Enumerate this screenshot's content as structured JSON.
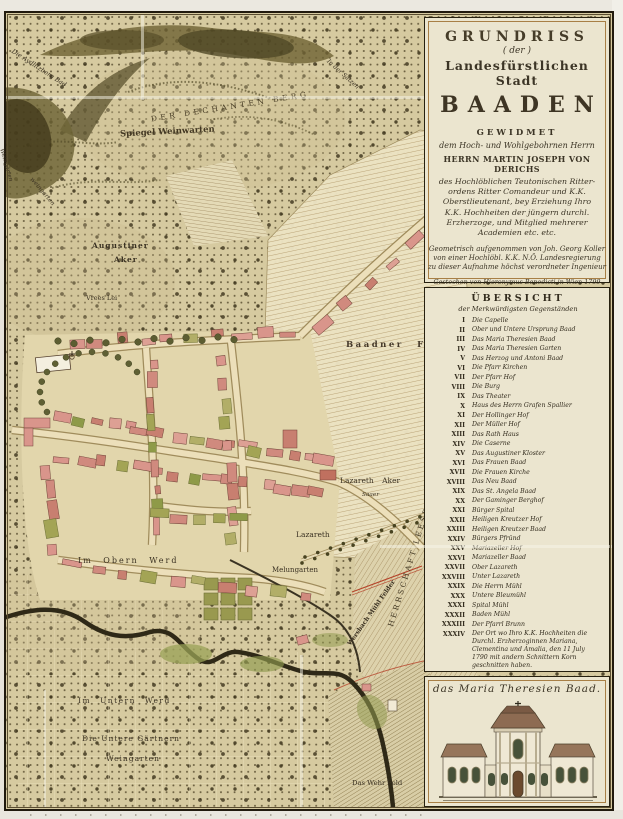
{
  "document_type": "Engraved town plan (hand-coloured), Baden bei Wien, 1799",
  "title_cartouche": {
    "line1": "GRUNDRISS",
    "line2": "( der )",
    "line3": "Landesfürstlichen Stadt",
    "line4": "BAADEN",
    "dedication_header": "GEWIDMET",
    "dedication_sub": "dem Hoch- und Wohlgebohrnen Herrn",
    "dedicatee": "HERRN MARTIN JOSEPH VON DERICHS",
    "dedication_lines": [
      "des Hochlöblichen Teutonischen Ritter-",
      "ordens Ritter Comandeur und K.K.",
      "Oberstlieutenant, bey Erziehung Ihro",
      "K.K. Hochheiten der jüngern durchl.",
      "Erzherzoge, und Mitglied mehrerer",
      "Academien etc. etc."
    ],
    "surveyor_lines": [
      "Geometrisch aufgenommen von Joh. Georg Koller",
      "von einer Hochlöbl. K.K. N.Ö. Landesregierung",
      "zu dieser Aufnahme höchst verordneter Ingenieur"
    ],
    "engraver_line": "Gestochen von Hieronymus Benedicti in Wien 1799"
  },
  "legend": {
    "title": "ÜBERSICHT",
    "subtitle": "der Merkwürdigsten Gegenständen",
    "entries": [
      {
        "numeral": "I",
        "label": "Die Capelle"
      },
      {
        "numeral": "II",
        "label": "Ober und Untere Ursprung Baad"
      },
      {
        "numeral": "III",
        "label": "Das Maria Theresien Baad"
      },
      {
        "numeral": "IV",
        "label": "Das Maria Theresien Garten"
      },
      {
        "numeral": "V",
        "label": "Das Herzog und Antoni Baad"
      },
      {
        "numeral": "VI",
        "label": "Die Pfarr Kirchen"
      },
      {
        "numeral": "VII",
        "label": "Der Pfarr Hof"
      },
      {
        "numeral": "VIII",
        "label": "Die Burg"
      },
      {
        "numeral": "IX",
        "label": "Das Theater"
      },
      {
        "numeral": "X",
        "label": "Haus des Herrn Grafen Spallier"
      },
      {
        "numeral": "XI",
        "label": "Der Hollinger Hof"
      },
      {
        "numeral": "XII",
        "label": "Der Müller Hof"
      },
      {
        "numeral": "XIII",
        "label": "Das Rath Haus"
      },
      {
        "numeral": "XIV",
        "label": "Die Caserne"
      },
      {
        "numeral": "XV",
        "label": "Das Augustiner Kloster"
      },
      {
        "numeral": "XVI",
        "label": "Das Frauen Baad"
      },
      {
        "numeral": "XVII",
        "label": "Die Frauen Kirche"
      },
      {
        "numeral": "XVIII",
        "label": "Das Neu Baad"
      },
      {
        "numeral": "XIX",
        "label": "Das St. Angela Baad"
      },
      {
        "numeral": "XX",
        "label": "Der Gaminger Berghof"
      },
      {
        "numeral": "XXI",
        "label": "Bürger Spital"
      },
      {
        "numeral": "XXII",
        "label": "Heiligen Kreutzer Hof"
      },
      {
        "numeral": "XXIII",
        "label": "Heiligen Kreutzer Baad"
      },
      {
        "numeral": "XXIV",
        "label": "Bürgers Pfründ"
      },
      {
        "numeral": "XXV",
        "label": "Mariazeller Hof"
      },
      {
        "numeral": "XXVI",
        "label": "Mariazeller Baad"
      },
      {
        "numeral": "XXVII",
        "label": "Ober Lazareth"
      },
      {
        "numeral": "XXVIII",
        "label": "Unter Lazareth"
      },
      {
        "numeral": "XXIX",
        "label": "Die Herrn Mühl"
      },
      {
        "numeral": "XXX",
        "label": "Untere Bleumühl"
      },
      {
        "numeral": "XXXI",
        "label": "Spital Mühl"
      },
      {
        "numeral": "XXXII",
        "label": "Baden Mühl"
      },
      {
        "numeral": "XXXIII",
        "label": "Der Pfarrl Brunn"
      },
      {
        "numeral": "XXXIV",
        "label": "Der Ort wo Ihro K.K. Hochheiten die Durchl. Erzherzoginnen Mariana, Clementina und Amalia, den 11 July 1790 mit andern Schnittern Korn geschnitten haben."
      }
    ]
  },
  "vignette": {
    "caption": "das Maria Theresien Baad."
  },
  "map_labels": {
    "dechanten_berg": "DER DECHANTEN BERG",
    "spiegel": "Spiegel Weinwarten",
    "aydlitz": "Die Aydlitzberg Bad",
    "edge_weingarten": "Weingärten",
    "curve_weingarten": "weingarten",
    "augustiner1": "Augustiner",
    "augustiner2": "Aker",
    "vrees": "Vrees Lei",
    "in_der_satzen": "In der Satzen",
    "baadner_feld": "Baadner  Feld",
    "lazareth_aker": "Lazareth  Aker",
    "saaer": "Saaer",
    "lazareth": "Lazareth",
    "im_obern_werd": "Im  Obern  Werd",
    "melungarten": "Melungarten",
    "herrschaft": "HERRSCHAFT  LEESDORF",
    "wersbach": "Wersbach Mühl Felder",
    "im_untern_werd": "Im  Untern  Werd",
    "untere_gaertnern1": "Die Untere Gärtnern",
    "untere_gaertnern2": "Weingarten",
    "wehr_feld": "Das Wehr Feld"
  },
  "colors": {
    "parchment": "#d6caa0",
    "ink": "#332c1e",
    "panel_background": "#ebe5cf",
    "gold_frame": "#a87f45",
    "building_pink": "#d9958b",
    "garden_green": "#9aa257",
    "hill_dark": "#5d5430",
    "river": "#2f2917",
    "red_accent": "#b5442a",
    "field_cream": "#ece3c3"
  }
}
